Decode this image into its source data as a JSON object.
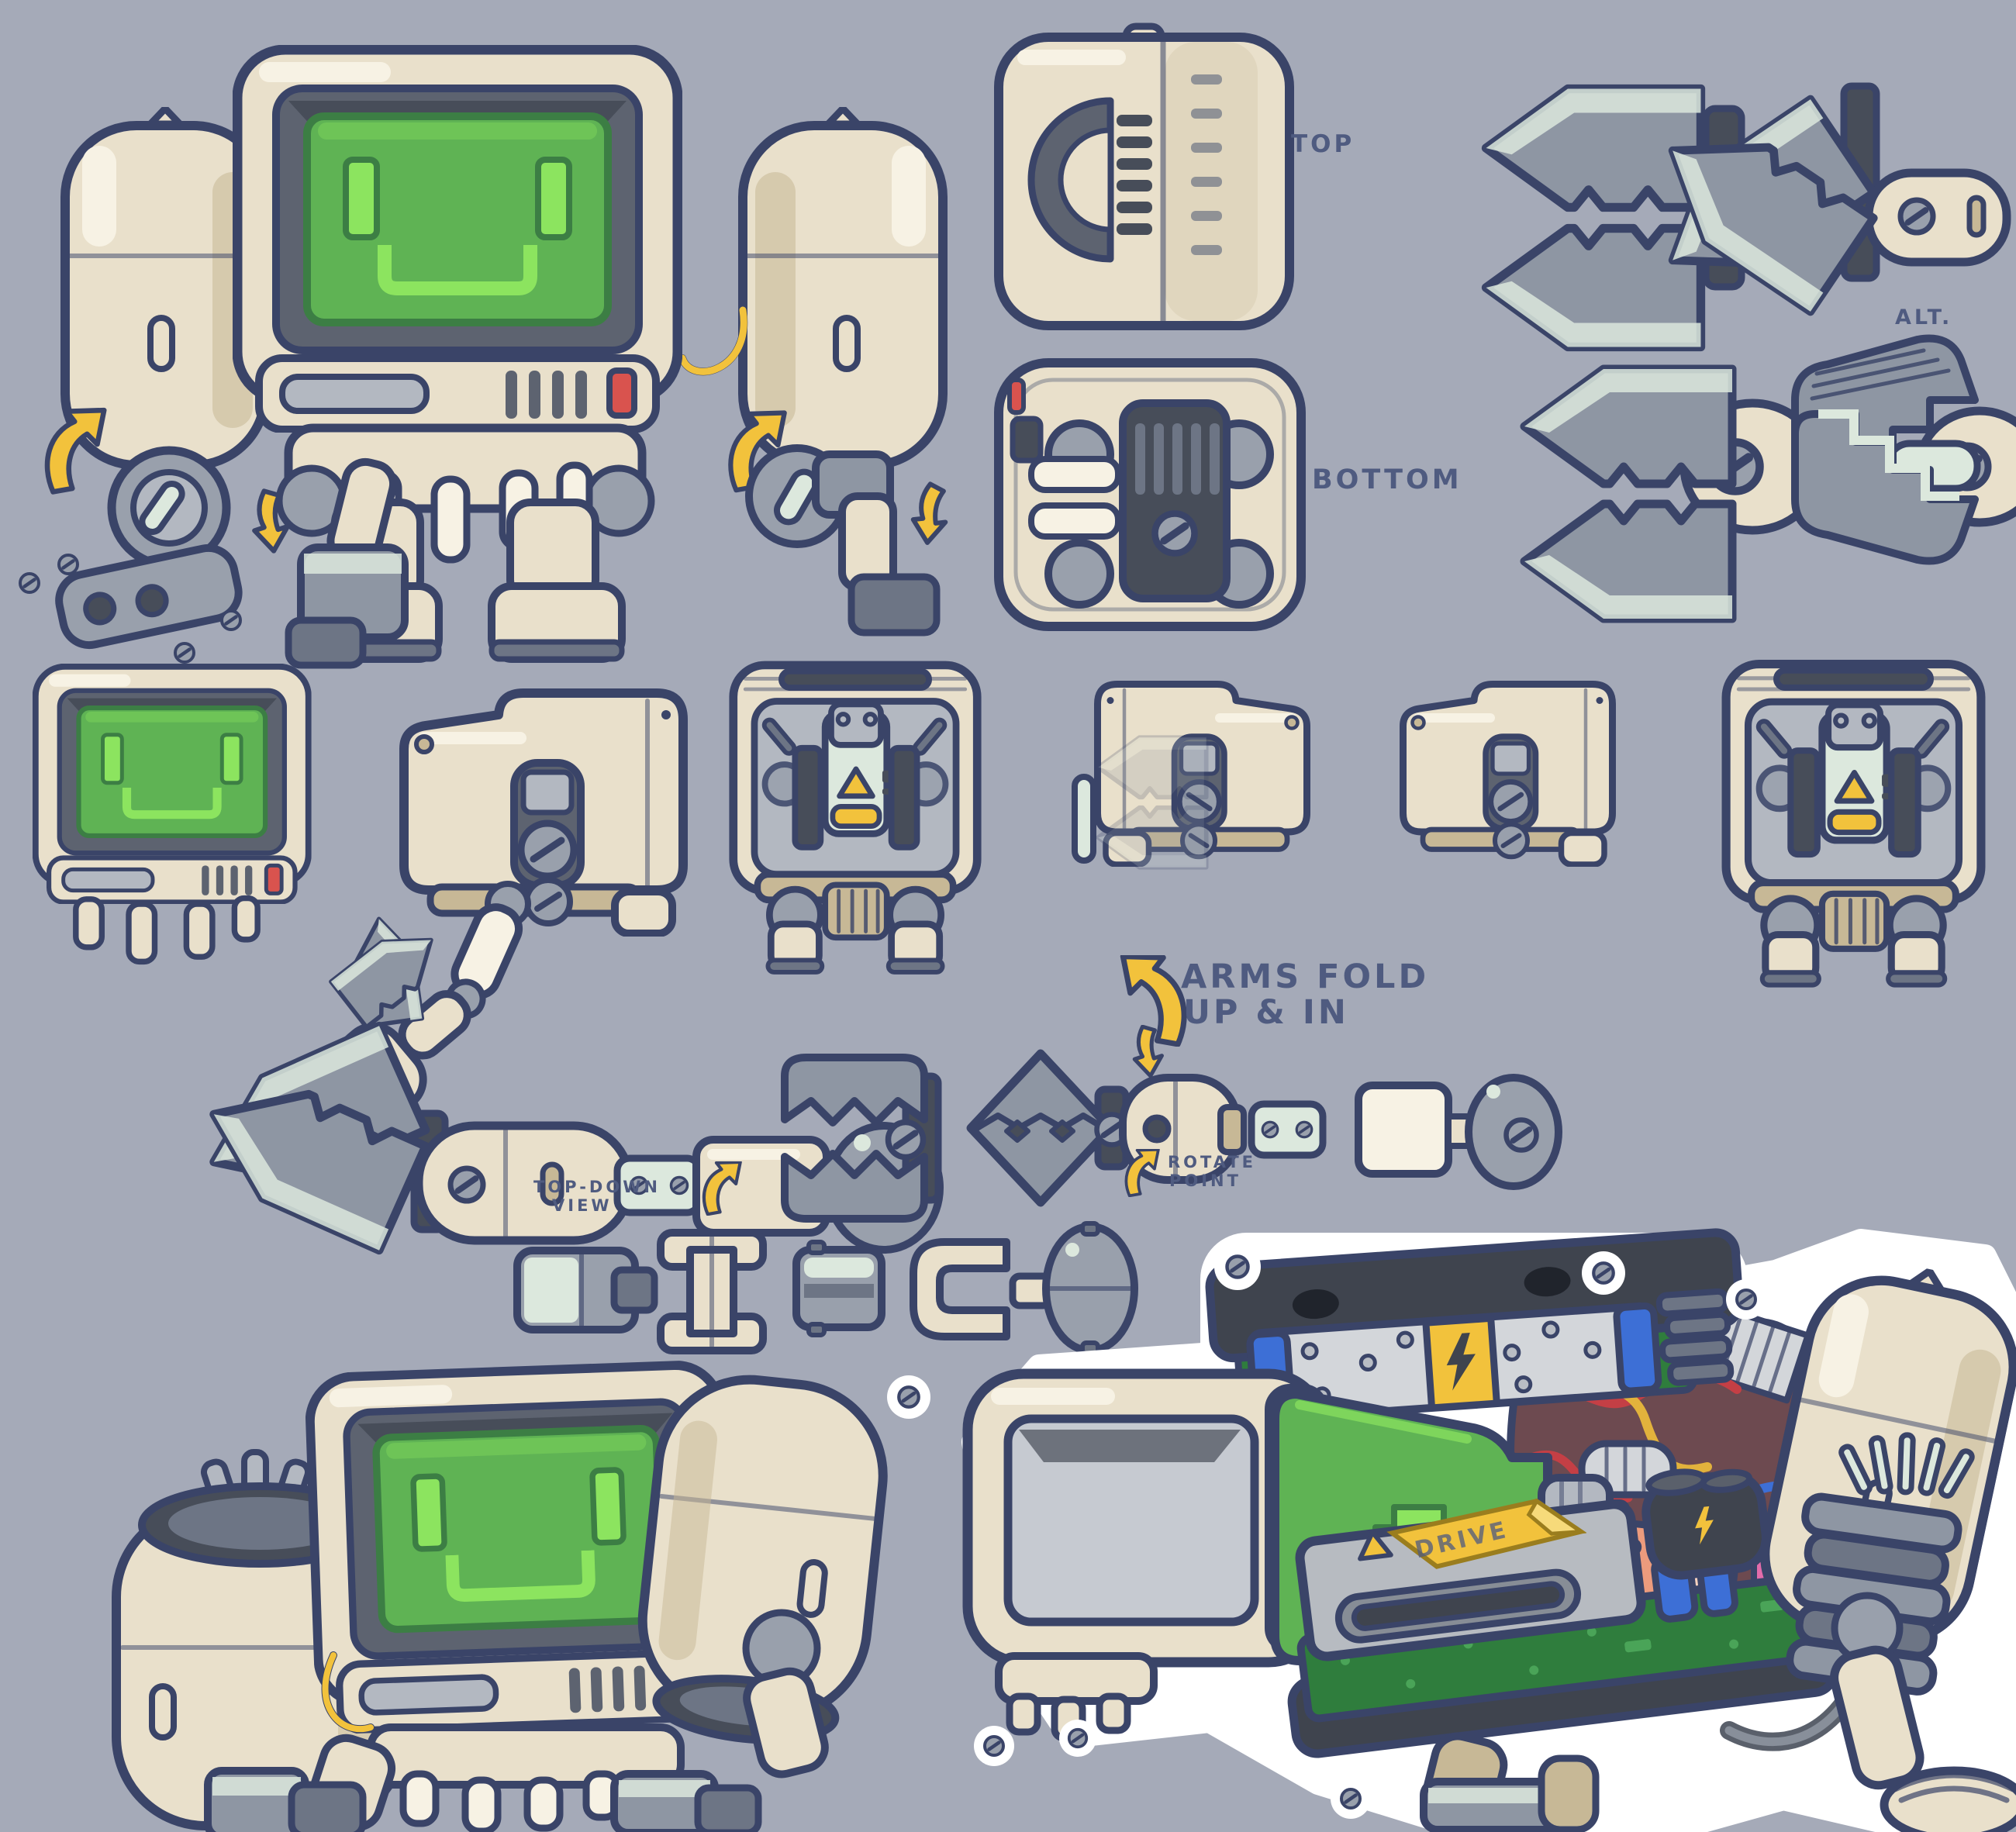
{
  "sheet": {
    "title": "Robot concept model sheet",
    "annotations": {
      "top": "TOP",
      "bottom": "BOTTOM",
      "alt": "ALT.",
      "arms_fold_line1": "ARMS FOLD",
      "arms_fold_line2": "UP & IN",
      "rotate_line1": "ROTATE",
      "rotate_line2": "POINT",
      "top_down_line1": "TOP-DOWN",
      "top_down_line2": "VIEW",
      "drive_label": "DRIVE"
    },
    "icons": {
      "lightning_bolt": "⚡",
      "warning_triangle": "▲",
      "fold_arrow": "↷",
      "down_arrow": "↓"
    }
  },
  "palette": {
    "background": "#a5aab8",
    "outline": "#3a4468",
    "annotation": "#4f5b80",
    "cream": "#e9e0cb",
    "cream_light": "#f7f2e4",
    "cream_shade": "#c7b896",
    "bezel": "#5d6370",
    "bezel_dark": "#474d59",
    "gray_panel": "#b3b8c1",
    "screen": "#5fb354",
    "screen_bright": "#8ce45f",
    "screen_dark": "#3c7e44",
    "steel": "#99a0ac",
    "steel_light": "#dce8dd",
    "steel_dark": "#6d7585",
    "claw": "#8e96a3",
    "yellow": "#f2c23c",
    "red": "#d9534e",
    "wire_red": "#c43f45",
    "wire_blue": "#3d6fd6",
    "wire_yellow": "#e2b23c",
    "board": "#2f7d3d",
    "board_light": "#4aa458",
    "maroon": "#6d4a50",
    "salmon": "#ec9b7d",
    "pink": "#e36cab",
    "dark": "#3f444e",
    "silver": "#d3d6da",
    "white": "#ffffff"
  }
}
